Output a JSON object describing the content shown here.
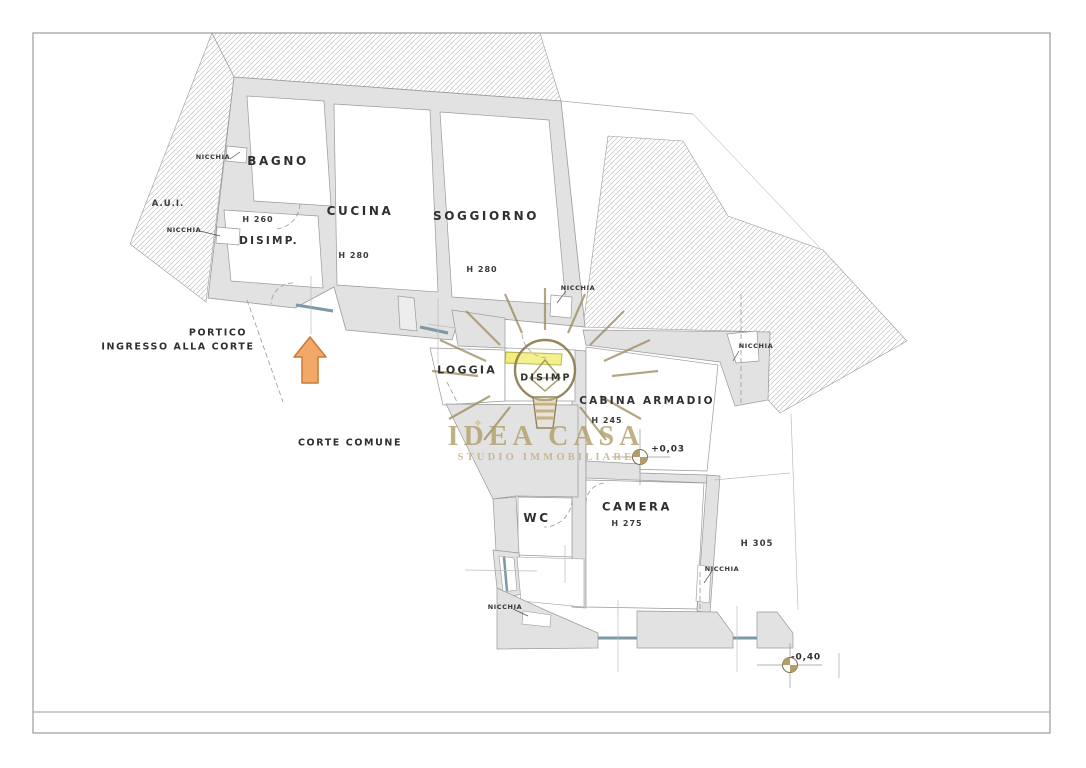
{
  "labels": {
    "nicchia": "NICCHIA",
    "bagno": "BAGNO",
    "aui": "A.U.I.",
    "h260": "H 260",
    "disimp_upper": "DISIMP.",
    "cucina": "CUCINA",
    "h280_cucina": "H 280",
    "soggiorno": "SOGGIORNO",
    "h280_soggiorno": "H 280",
    "portico": "PORTICO",
    "ingresso_alla_corte": "INGRESSO ALLA CORTE",
    "corte_comune": "CORTE COMUNE",
    "loggia": "LOGGIA",
    "disimp_lower": "DISIMP",
    "cabina_armadio": "CABINA ARMADIO",
    "h245": "H 245",
    "plus_003": "+0,03",
    "wc": "WC",
    "camera": "CAMERA",
    "h275": "H 275",
    "h305": "H 305",
    "minus_040": "-0,40",
    "sparkle": "✦"
  },
  "watermark": {
    "title": "IDEA CASA",
    "subtitle": "STUDIO IMMOBILIARE"
  },
  "colors": {
    "wall_fill": "#e2e2e2",
    "wall_stroke": "#9a9a9a",
    "hatch_line": "#b5b5b5",
    "window_blue": "#7e98a6",
    "highlight_yellow": "#f3ee7c",
    "arrow_orange": "#f2a868",
    "watermark_gold": "#b3a06b",
    "marker_tan": "#b49d69",
    "frame_gray": "#9b9b9b",
    "label_text": "#2f2f2f"
  }
}
